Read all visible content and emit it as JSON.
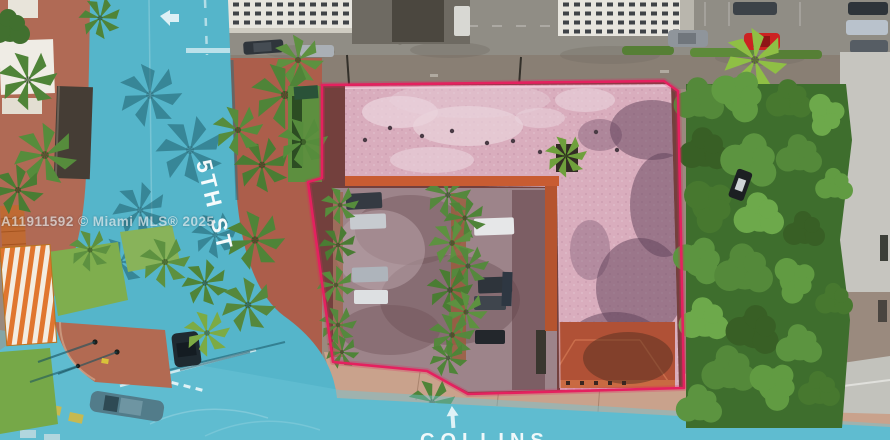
{
  "watermark": {
    "listing_id": "A11911592",
    "text": "A11911592 © Miami MLS® 2025"
  },
  "streets": {
    "side": "5TH ST",
    "bottom": "COLLINS"
  },
  "property": {
    "outline_color": "#e4215f"
  },
  "palette": {
    "road_teal": "#55b5ca",
    "intersection_teal": "#6cc5d8",
    "roof_pink": "#d9adbd",
    "roof_terracotta": "#b05136",
    "parapet_orange": "#c85c32",
    "courtyard": "#9d848a",
    "brick_sidewalk": "#ac5e4b",
    "alley_gray": "#908d85",
    "tree_green": "#3e6e2d",
    "lawn_green": "#7fae4e",
    "south_sidewalk": "#c9a28c",
    "concrete_light": "#c6c5bf",
    "label_text": "#ffffff"
  }
}
